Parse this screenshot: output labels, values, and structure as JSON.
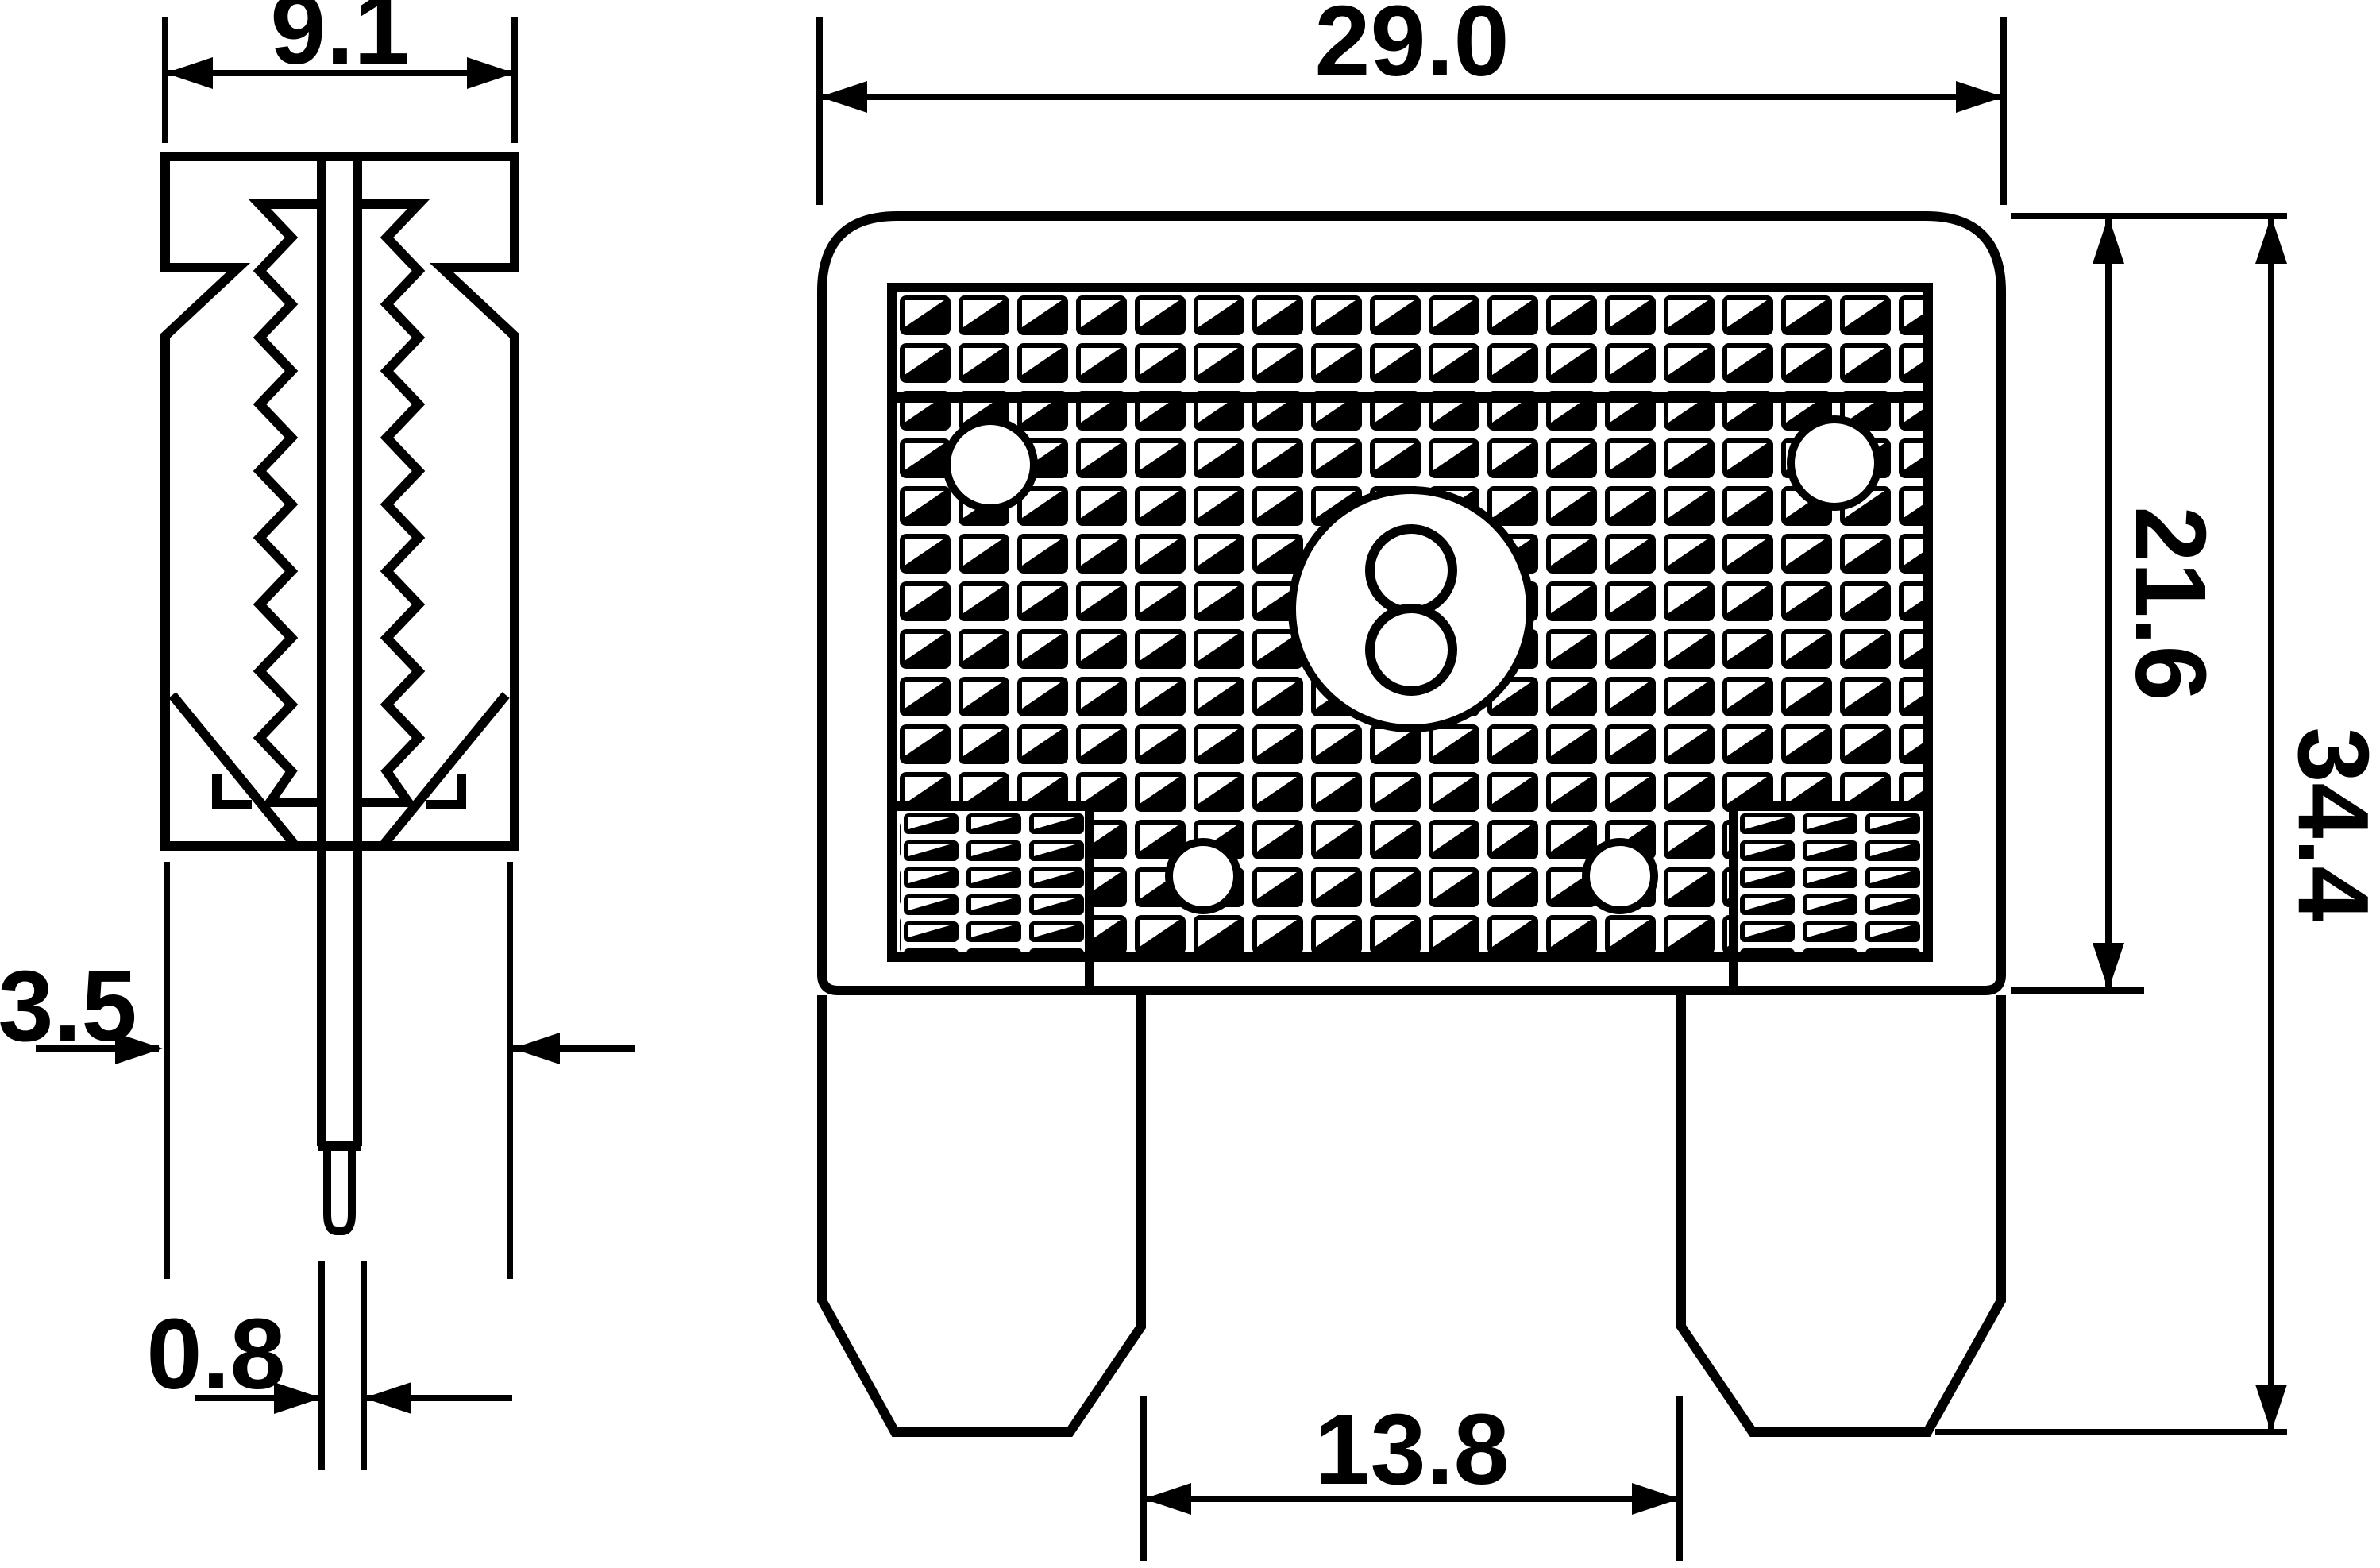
{
  "drawing": {
    "background": "#ffffff",
    "stroke": "#000000",
    "description_views": {
      "left": "side-view-of-blade-fuse",
      "right": "front-view-of-blade-fuse"
    }
  },
  "dimensions": {
    "side_width": {
      "value": "9.1"
    },
    "front_width": {
      "value": "29.0"
    },
    "body_height": {
      "value": "21.6"
    },
    "overall_height": {
      "value": "34.4"
    },
    "lower_thickness": {
      "value": "3.5"
    },
    "blade_thickness": {
      "value": "0.8"
    },
    "blade_spacing": {
      "value": "13.8"
    }
  }
}
